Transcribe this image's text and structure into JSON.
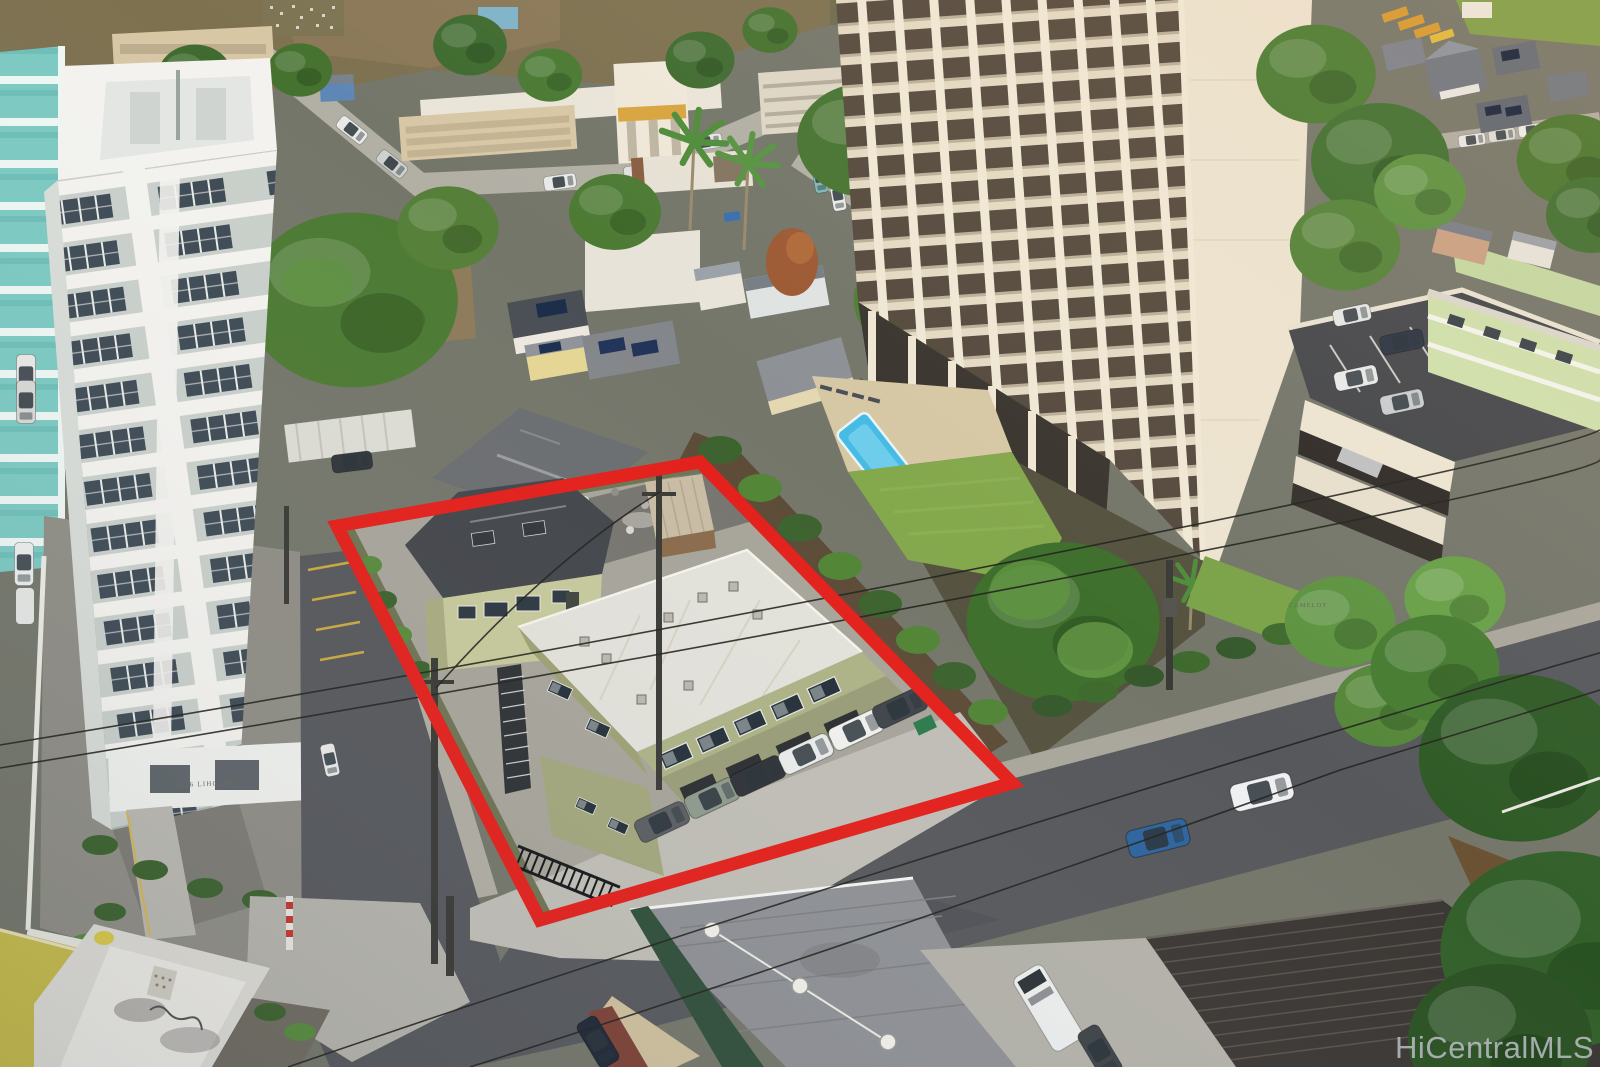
{
  "watermark": {
    "text": "HiCentralMLS"
  },
  "signs": {
    "left_tower": "1616 LIHOLIHO",
    "right_tower": "CAMELOT"
  },
  "palette": {
    "red": "#e3201b",
    "asphalt": "#56585c",
    "concrete": "#c0beb6",
    "sidewalk": "#a9a69b",
    "towerWhite": "#f3f2ee",
    "towerPanel": "#c9cfca",
    "windowDark": "#3e4a54",
    "teal": "#7cc9c2",
    "creamWall": "#ece3cf",
    "balconyCell": "#6e6152",
    "balconyDeep": "#554a3d",
    "oliveWall": "#aeb286",
    "oliveShade": "#999d78",
    "roofWhite": "#e2e1da",
    "houseGreen": "#c6c99b",
    "roofDark": "#43464a",
    "vegDark": "#3c622e",
    "veg": "#578a3c",
    "lawn": "#84a84c",
    "pool": "#45bce4",
    "dirt": "#8d7b5a",
    "tanBldg": "#d7c7a5",
    "greenApt": "#cfe0ac",
    "deck": "#45474b",
    "rustRoof": "#3b3734",
    "yellowBldg": "#c6bb4b",
    "sand": "#d6c8a4",
    "rockWall": "#5c4b37",
    "grayRoof": "#8e9094",
    "fenceGreen": "#6d7452"
  }
}
